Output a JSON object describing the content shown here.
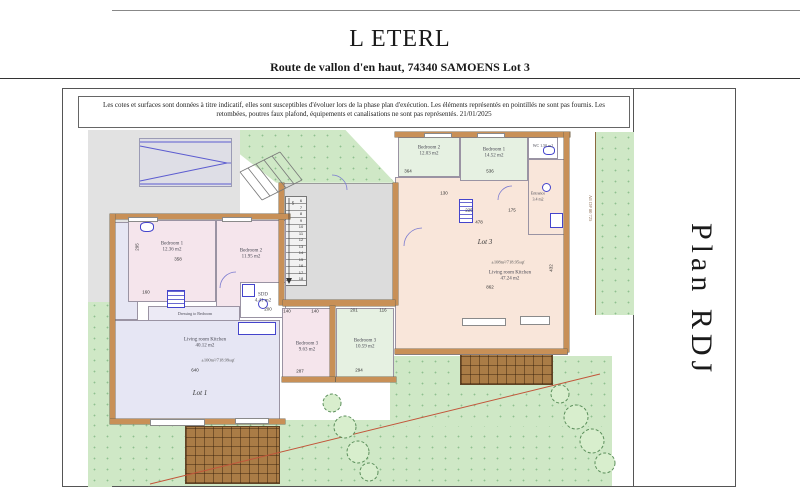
{
  "header": {
    "title": "L ETERL",
    "subtitle": "Route de vallon d'en haut, 74340 SAMOENS Lot 3"
  },
  "disclaimer": "Les cotes et surfaces sont données à titre indicatif, elles sont susceptibles d'évoluer lors de la phase plan d'exécution. Les éléments représentés en pointillés ne sont pas fournis. Les retombées, poutres faux plafond, équipements et canalisations ne sont pas représentés. 21/01/2025",
  "plan_title": "Plan RDJ",
  "colors": {
    "grass": "#cfe8c6",
    "terrace": "#aa7c46",
    "wall_hatch": "#c89057",
    "lot1_bedroom_fill": "#f5e5ec",
    "lot1_living_fill": "#e6e6f4",
    "lot3_bedroom_fill": "#e6f1e2",
    "lot3_living_fill": "#f9e6da",
    "fixture_blue": "#4444cc",
    "boundary_red": "#c2553a"
  },
  "lot1": {
    "label": "Lot 1",
    "area_note": "±100m²/718.99sqf",
    "bedroom1": {
      "name": "Bedroom 1",
      "area": "12.36 m2"
    },
    "bedroom2": {
      "name": "Bedroom 2",
      "area": "11.95 m2"
    },
    "bedroom3": {
      "name": "Bedroom 3",
      "area": "9.63 m2"
    },
    "living": {
      "name": "Living room Kitchen",
      "area": "40.12 m2"
    },
    "sdd": {
      "name": "SDD",
      "area": "4.41 m2"
    },
    "dressing": {
      "name": "Dressing to Bedroom"
    }
  },
  "lot3": {
    "label": "Lot 3",
    "area_note": "±108m²/718.95sqf",
    "bedroom1": {
      "name": "Bedroom 1",
      "area": "14.52 m2"
    },
    "bedroom2": {
      "name": "Bedroom 2",
      "area": "12.03 m2"
    },
    "bedroom3": {
      "name": "Bedroom 3",
      "area": "10.59 m2"
    },
    "wc": {
      "name": "WC",
      "area": "1.50 m2"
    },
    "entrance": {
      "name": "Entrance",
      "area": "3.4 m2"
    },
    "living": {
      "name": "Living room Kitchen",
      "area": "47.24 m2"
    }
  },
  "stairs": {
    "numbers": "6\n7\n8\n9\n10\n11\n12\n13\n14\n15\n16\n17\n18"
  },
  "boundary_marker": "AE DP 80 725",
  "dims": [
    {
      "t": "364"
    },
    {
      "t": "536"
    },
    {
      "t": "130"
    },
    {
      "t": "225"
    },
    {
      "t": "175"
    },
    {
      "t": "478"
    },
    {
      "t": "432"
    },
    {
      "t": "287"
    },
    {
      "t": "294"
    },
    {
      "t": "140"
    },
    {
      "t": "140"
    },
    {
      "t": "201"
    },
    {
      "t": "116"
    },
    {
      "t": "358"
    },
    {
      "t": "160"
    },
    {
      "t": "295"
    },
    {
      "t": "862"
    },
    {
      "t": "640"
    },
    {
      "t": "200"
    },
    {
      "t": "5"
    }
  ]
}
